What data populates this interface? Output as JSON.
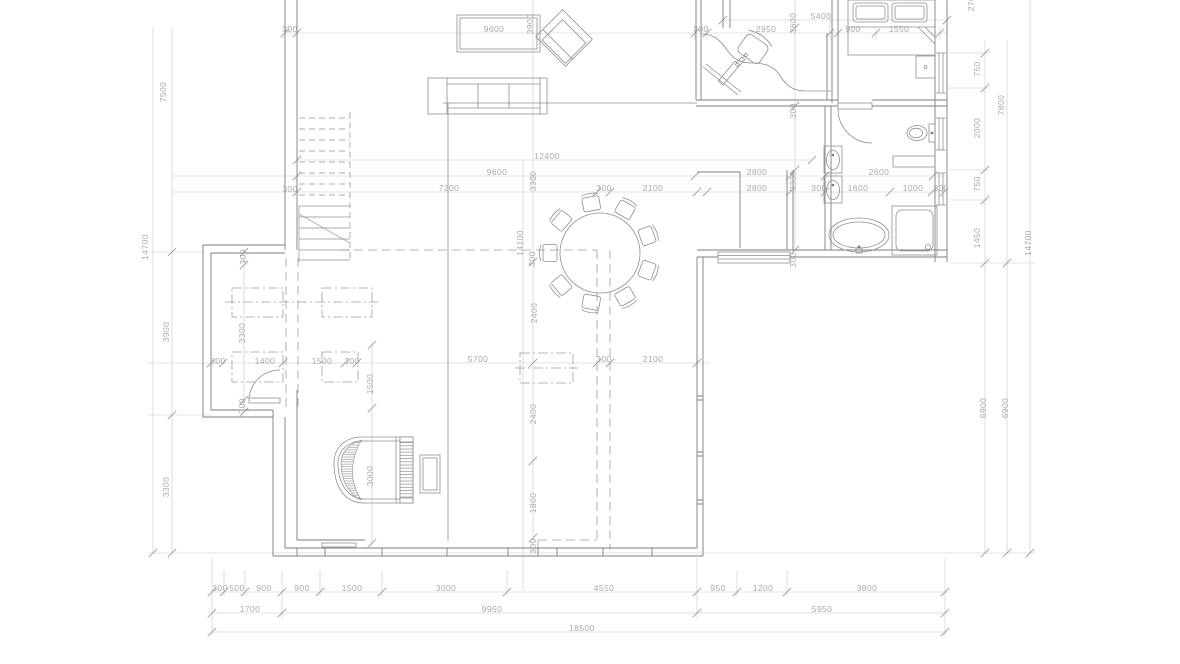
{
  "drawing": {
    "kind": "architectural floor plan, ground floor with living room, round dining table, grand piano, office nook, bedroom and bathroom",
    "units": "millimeters"
  },
  "colors": {
    "background": "#ffffff",
    "walls": "#7b7e81",
    "furniture": "#8d9093",
    "dimension_lines": "#c6c8ca",
    "dimension_text": "#a6a9ab"
  },
  "labels": [
    "300",
    "9600",
    "300",
    "2950",
    "5400",
    "900",
    "1550",
    "12400",
    "9600",
    "2800",
    "2600",
    "7200",
    "300",
    "2100",
    "2800",
    "300",
    "1600",
    "1000",
    "300",
    "300",
    "300",
    "1400",
    "1500",
    "300",
    "5700",
    "300",
    "2100",
    "300",
    "500",
    "900",
    "900",
    "1500",
    "3000",
    "4550",
    "950",
    "1200",
    "3800",
    "1700",
    "9950",
    "5950",
    "18500",
    "7500",
    "14700",
    "3900",
    "3300",
    "3900",
    "3300",
    "14100",
    "300",
    "2400",
    "2400",
    "1800",
    "300",
    "3000",
    "1500",
    "300",
    "3300",
    "300",
    "3600",
    "300",
    "3300",
    "300",
    "750",
    "2000",
    "750",
    "1450",
    "6900",
    "6900",
    "7800",
    "14700",
    "2700"
  ]
}
